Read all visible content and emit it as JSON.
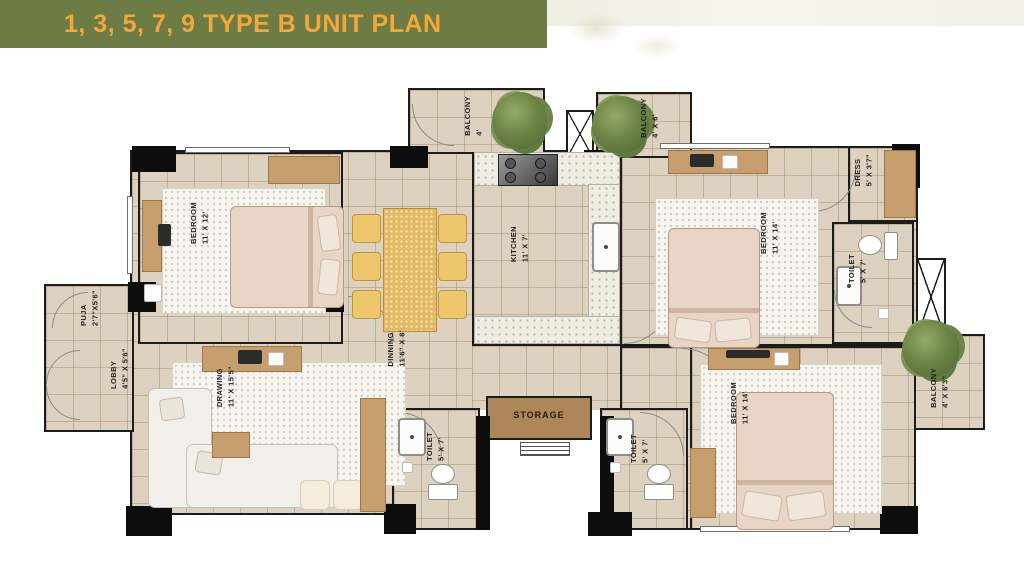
{
  "header": {
    "title": "1, 3, 5, 7, 9 TYPE B UNIT PLAN"
  },
  "rooms": {
    "bedroom1": {
      "name": "BEDROOM",
      "dims": "11' X 12'"
    },
    "puja": {
      "name": "PUJA",
      "dims": "2'7\"X5'6\""
    },
    "lobby": {
      "name": "LOBBY",
      "dims": "4'5\" X 5'6\""
    },
    "drawing": {
      "name": "DRAWING",
      "dims": "11' X 15'5\""
    },
    "dinning": {
      "name": "DINNING",
      "dims": "11'6\" X 8'"
    },
    "kitchen": {
      "name": "KITCHEN",
      "dims": "11' X 7'"
    },
    "balcony_top_left": {
      "name": "BALCONY",
      "dims": "4'"
    },
    "balcony_top_right": {
      "name": "BALCONY",
      "dims": "4' X 6'"
    },
    "bedroom2": {
      "name": "BEDROOM",
      "dims": "11' X 14'"
    },
    "dress": {
      "name": "DRESS",
      "dims": "5' X 3'7\""
    },
    "toilet1": {
      "name": "TOILET",
      "dims": "5' X 7'"
    },
    "bedroom3": {
      "name": "BEDROOM",
      "dims": "11' X 14'"
    },
    "balcony_right": {
      "name": "BALCONY",
      "dims": "4' X 6'3\""
    },
    "toilet2": {
      "name": "TOILET",
      "dims": "5' X 7'"
    },
    "toilet3": {
      "name": "TOILET",
      "dims": "5' X 7'"
    },
    "storage": {
      "name": "STORAGE"
    }
  },
  "colors": {
    "banner_green": "#6d7b44",
    "title_orange": "#f2a93a",
    "floor_tile": "#ddd2bf",
    "wall_black": "#1c1c1c",
    "furniture_wood": "#c79e6d",
    "storage_brown": "#ad8659",
    "plant_green": "#6d8447"
  }
}
